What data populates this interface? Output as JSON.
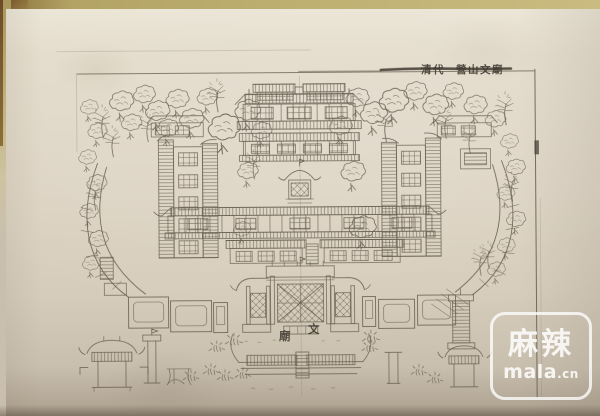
{
  "plate": {
    "caption_dynasty": "清代",
    "caption_title": "營山文廟",
    "gate_label": "文廟",
    "gate_label_display": [
      "廟",
      "文"
    ]
  },
  "watermark": {
    "brand": "麻辣",
    "domain": "mala",
    "tld": ".cn"
  },
  "colors": {
    "book_edge": "#b3a465",
    "corner_shadow": "#6f4a28",
    "page_light": "#ebe5d6",
    "page": "#ddd4c4",
    "page_dark": "#c9bfae",
    "ink": "#5c5447",
    "ink_dark": "#3a332a",
    "caption_ink": "#403a31",
    "watermark": "#ffffff"
  }
}
